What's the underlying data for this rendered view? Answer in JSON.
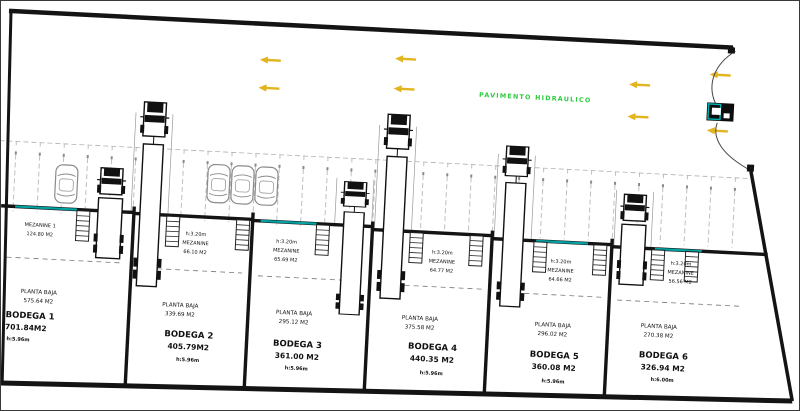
{
  "plan": {
    "pavement_label": "PAVIMENTO HIDRAULICO",
    "units": [
      {
        "name": "BODEGA 1",
        "area": "701.84M2",
        "height": "h:5.96m",
        "planta_label": "PLANTA BAJA",
        "planta_area": "575.64 M2",
        "mezzanine_height": "",
        "mezzanine_label": "MEZANINE 1",
        "mezzanine_area": "124.80 M2"
      },
      {
        "name": "BODEGA 2",
        "area": "405.79M2",
        "height": "h:5.96m",
        "planta_label": "PLANTA BAJA",
        "planta_area": "339.69 M2",
        "mezzanine_height": "h:3.20m",
        "mezzanine_label": "MEZANINE",
        "mezzanine_area": "66.10 M2"
      },
      {
        "name": "BODEGA 3",
        "area": "361.00 M2",
        "height": "h:5.96m",
        "planta_label": "PLANTA BAJA",
        "planta_area": "295.12 M2",
        "mezzanine_height": "h:3.20m",
        "mezzanine_label": "MEZANINE",
        "mezzanine_area": "65.69 M2"
      },
      {
        "name": "BODEGA 4",
        "area": "440.35 M2",
        "height": "h:5.96m",
        "planta_label": "PLANTA BAJA",
        "planta_area": "375.58 M2",
        "mezzanine_height": "h:3.20m",
        "mezzanine_label": "MEZANINE",
        "mezzanine_area": "64.77 M2"
      },
      {
        "name": "BODEGA 5",
        "area": "360.08 M2",
        "height": "h:5.96m",
        "planta_label": "PLANTA BAJA",
        "planta_area": "296.02 M2",
        "mezzanine_height": "h:3.20m",
        "mezzanine_label": "MEZANINE",
        "mezzanine_area": "64.66 M2"
      },
      {
        "name": "BODEGA 6",
        "area": "326.94 M2",
        "height": "h:6.00m",
        "planta_label": "PLANTA BAJA",
        "planta_area": "270.38 M2",
        "mezzanine_height": "h:3.20m",
        "mezzanine_label": "MEZANINE",
        "mezzanine_area": "56.56 M2"
      }
    ],
    "colors": {
      "wall_black": "#141414",
      "accent_teal": "#00a2a2",
      "arrow_yellow": "#e2b51f",
      "pavement_green": "#2ecc40"
    }
  }
}
